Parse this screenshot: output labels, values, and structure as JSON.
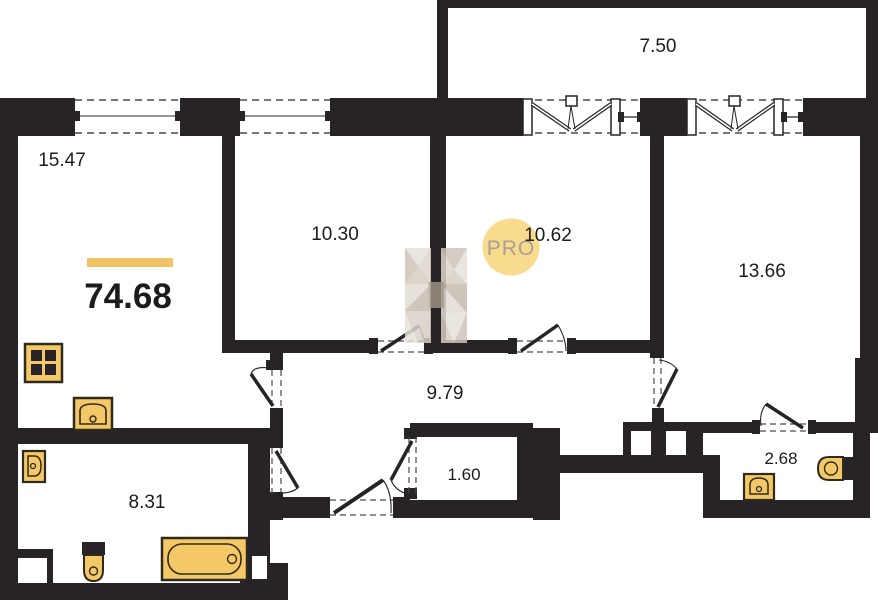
{
  "plan": {
    "total_area": "74.68",
    "rooms": [
      {
        "id": "living-room",
        "area": "15.47"
      },
      {
        "id": "bedroom-1",
        "area": "10.30"
      },
      {
        "id": "bedroom-2",
        "area": "10.62"
      },
      {
        "id": "bedroom-3",
        "area": "13.66"
      },
      {
        "id": "balcony",
        "area": "7.50"
      },
      {
        "id": "hallway",
        "area": "9.79"
      },
      {
        "id": "storage",
        "area": "1.60"
      },
      {
        "id": "bathroom",
        "area": "8.31"
      },
      {
        "id": "wc",
        "area": "2.68"
      }
    ],
    "watermark": {
      "logo": "H",
      "label": "PRO"
    },
    "fixtures": [
      "stove",
      "kitchen-sink",
      "wall-sink",
      "toilet",
      "bathtub",
      "wc-sink",
      "wc-toilet"
    ],
    "colors": {
      "wall": "#272327",
      "fixture_fill": "#f5c867",
      "fixture_border": "#2e2a1e",
      "accent_bar": "#f0c464",
      "watermark_circle": "#f9d987",
      "watermark_text": "#a7a195",
      "watermark_logo": "#d5cec4"
    }
  }
}
